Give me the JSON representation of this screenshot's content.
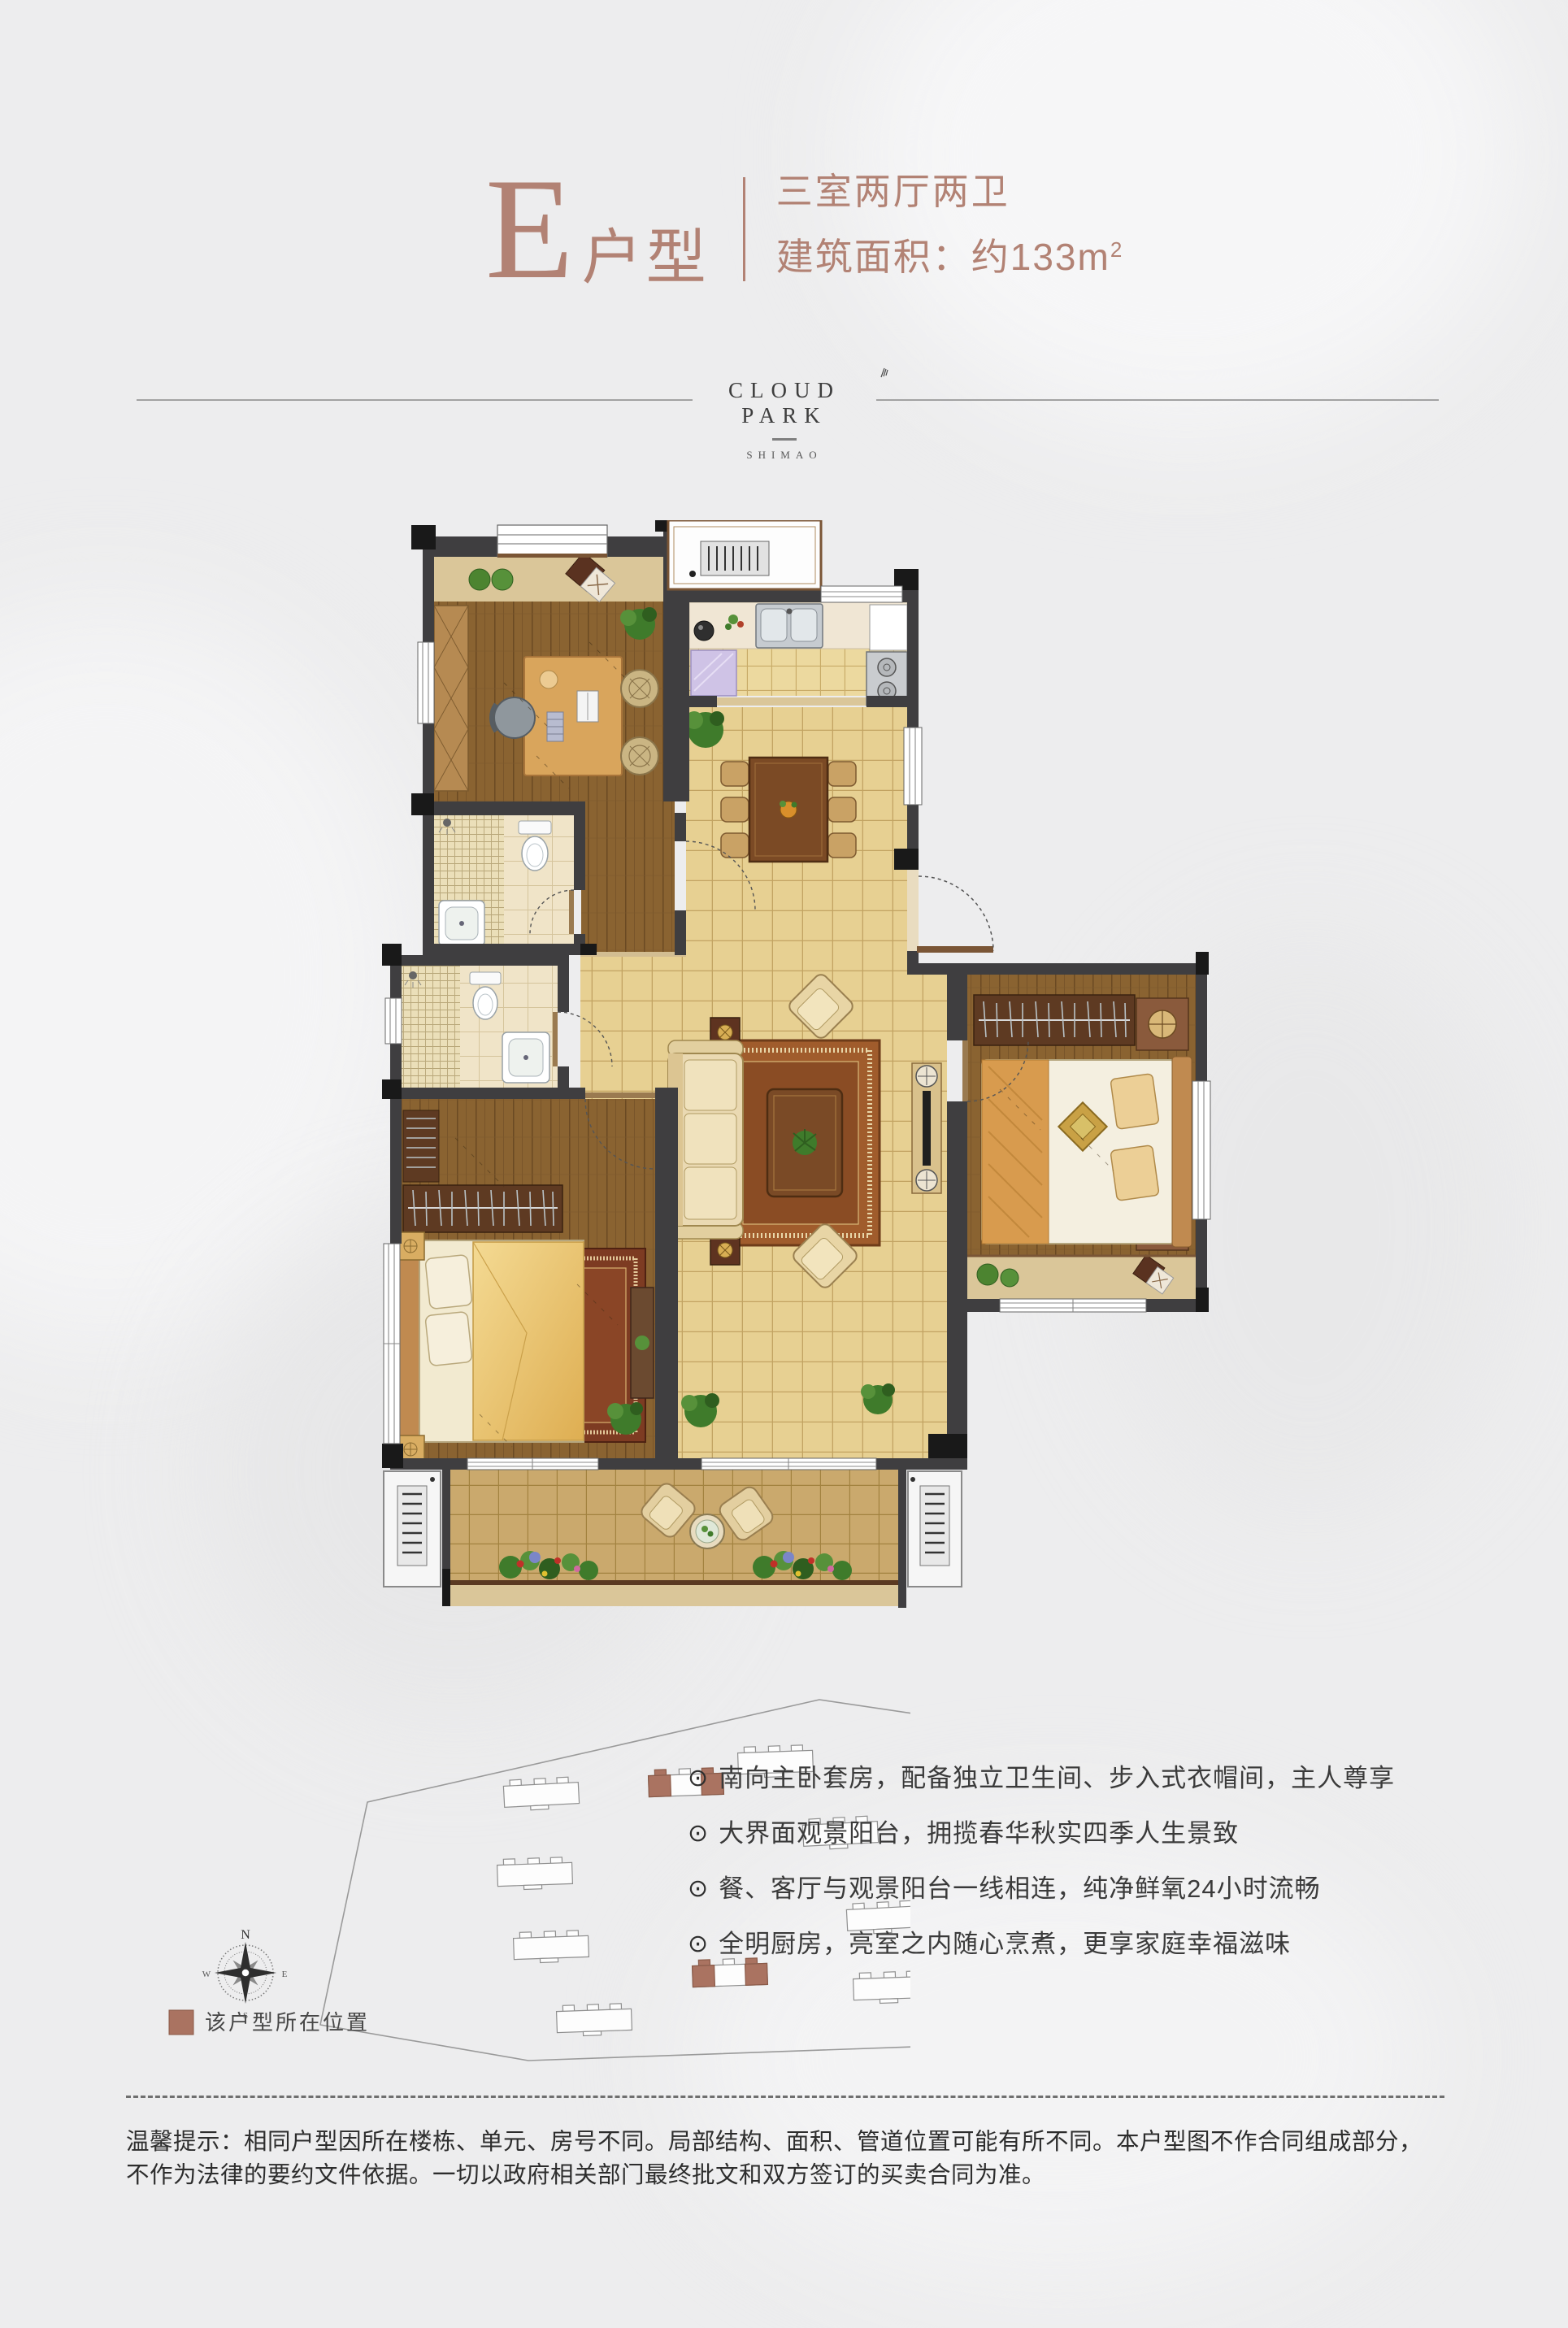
{
  "header": {
    "unit_letter": "E",
    "unit_suffix": "户型",
    "rooms_line": "三室两厅两卫",
    "area_label": "建筑面积：约133m",
    "area_sup": "2"
  },
  "logo": {
    "name": "CLOUD PARK",
    "sub": "SHIMAO"
  },
  "features": {
    "bullet": "⊙",
    "items": [
      "南向主卧套房，配备独立卫生间、步入式衣帽间，主人尊享",
      "大界面观景阳台，拥揽春华秋实四季人生景致",
      "餐、客厅与观景阳台一线相连，纯净鲜氧24小时流畅",
      "全明厨房，亮室之内随心烹煮，更享家庭幸福滋味"
    ]
  },
  "site_plan": {
    "legend_label": "该户型所在位置",
    "compass": {
      "n": "N",
      "s": "S",
      "e": "E",
      "w": "W"
    }
  },
  "disclaimer": {
    "text": "温馨提示：相同户型因所在楼栋、单元、房号不同。局部结构、面积、管道位置可能有所不同。本户型图不作合同组成部分，不作为法律的要约文件依据。一切以政府相关部门最终批文和双方签订的买卖合同为准。"
  },
  "colors": {
    "accent": "#b28274",
    "wall": "#3f3e40",
    "highlight": "#aa7361",
    "tile": "#e7d092",
    "wood": "#8a6331"
  }
}
